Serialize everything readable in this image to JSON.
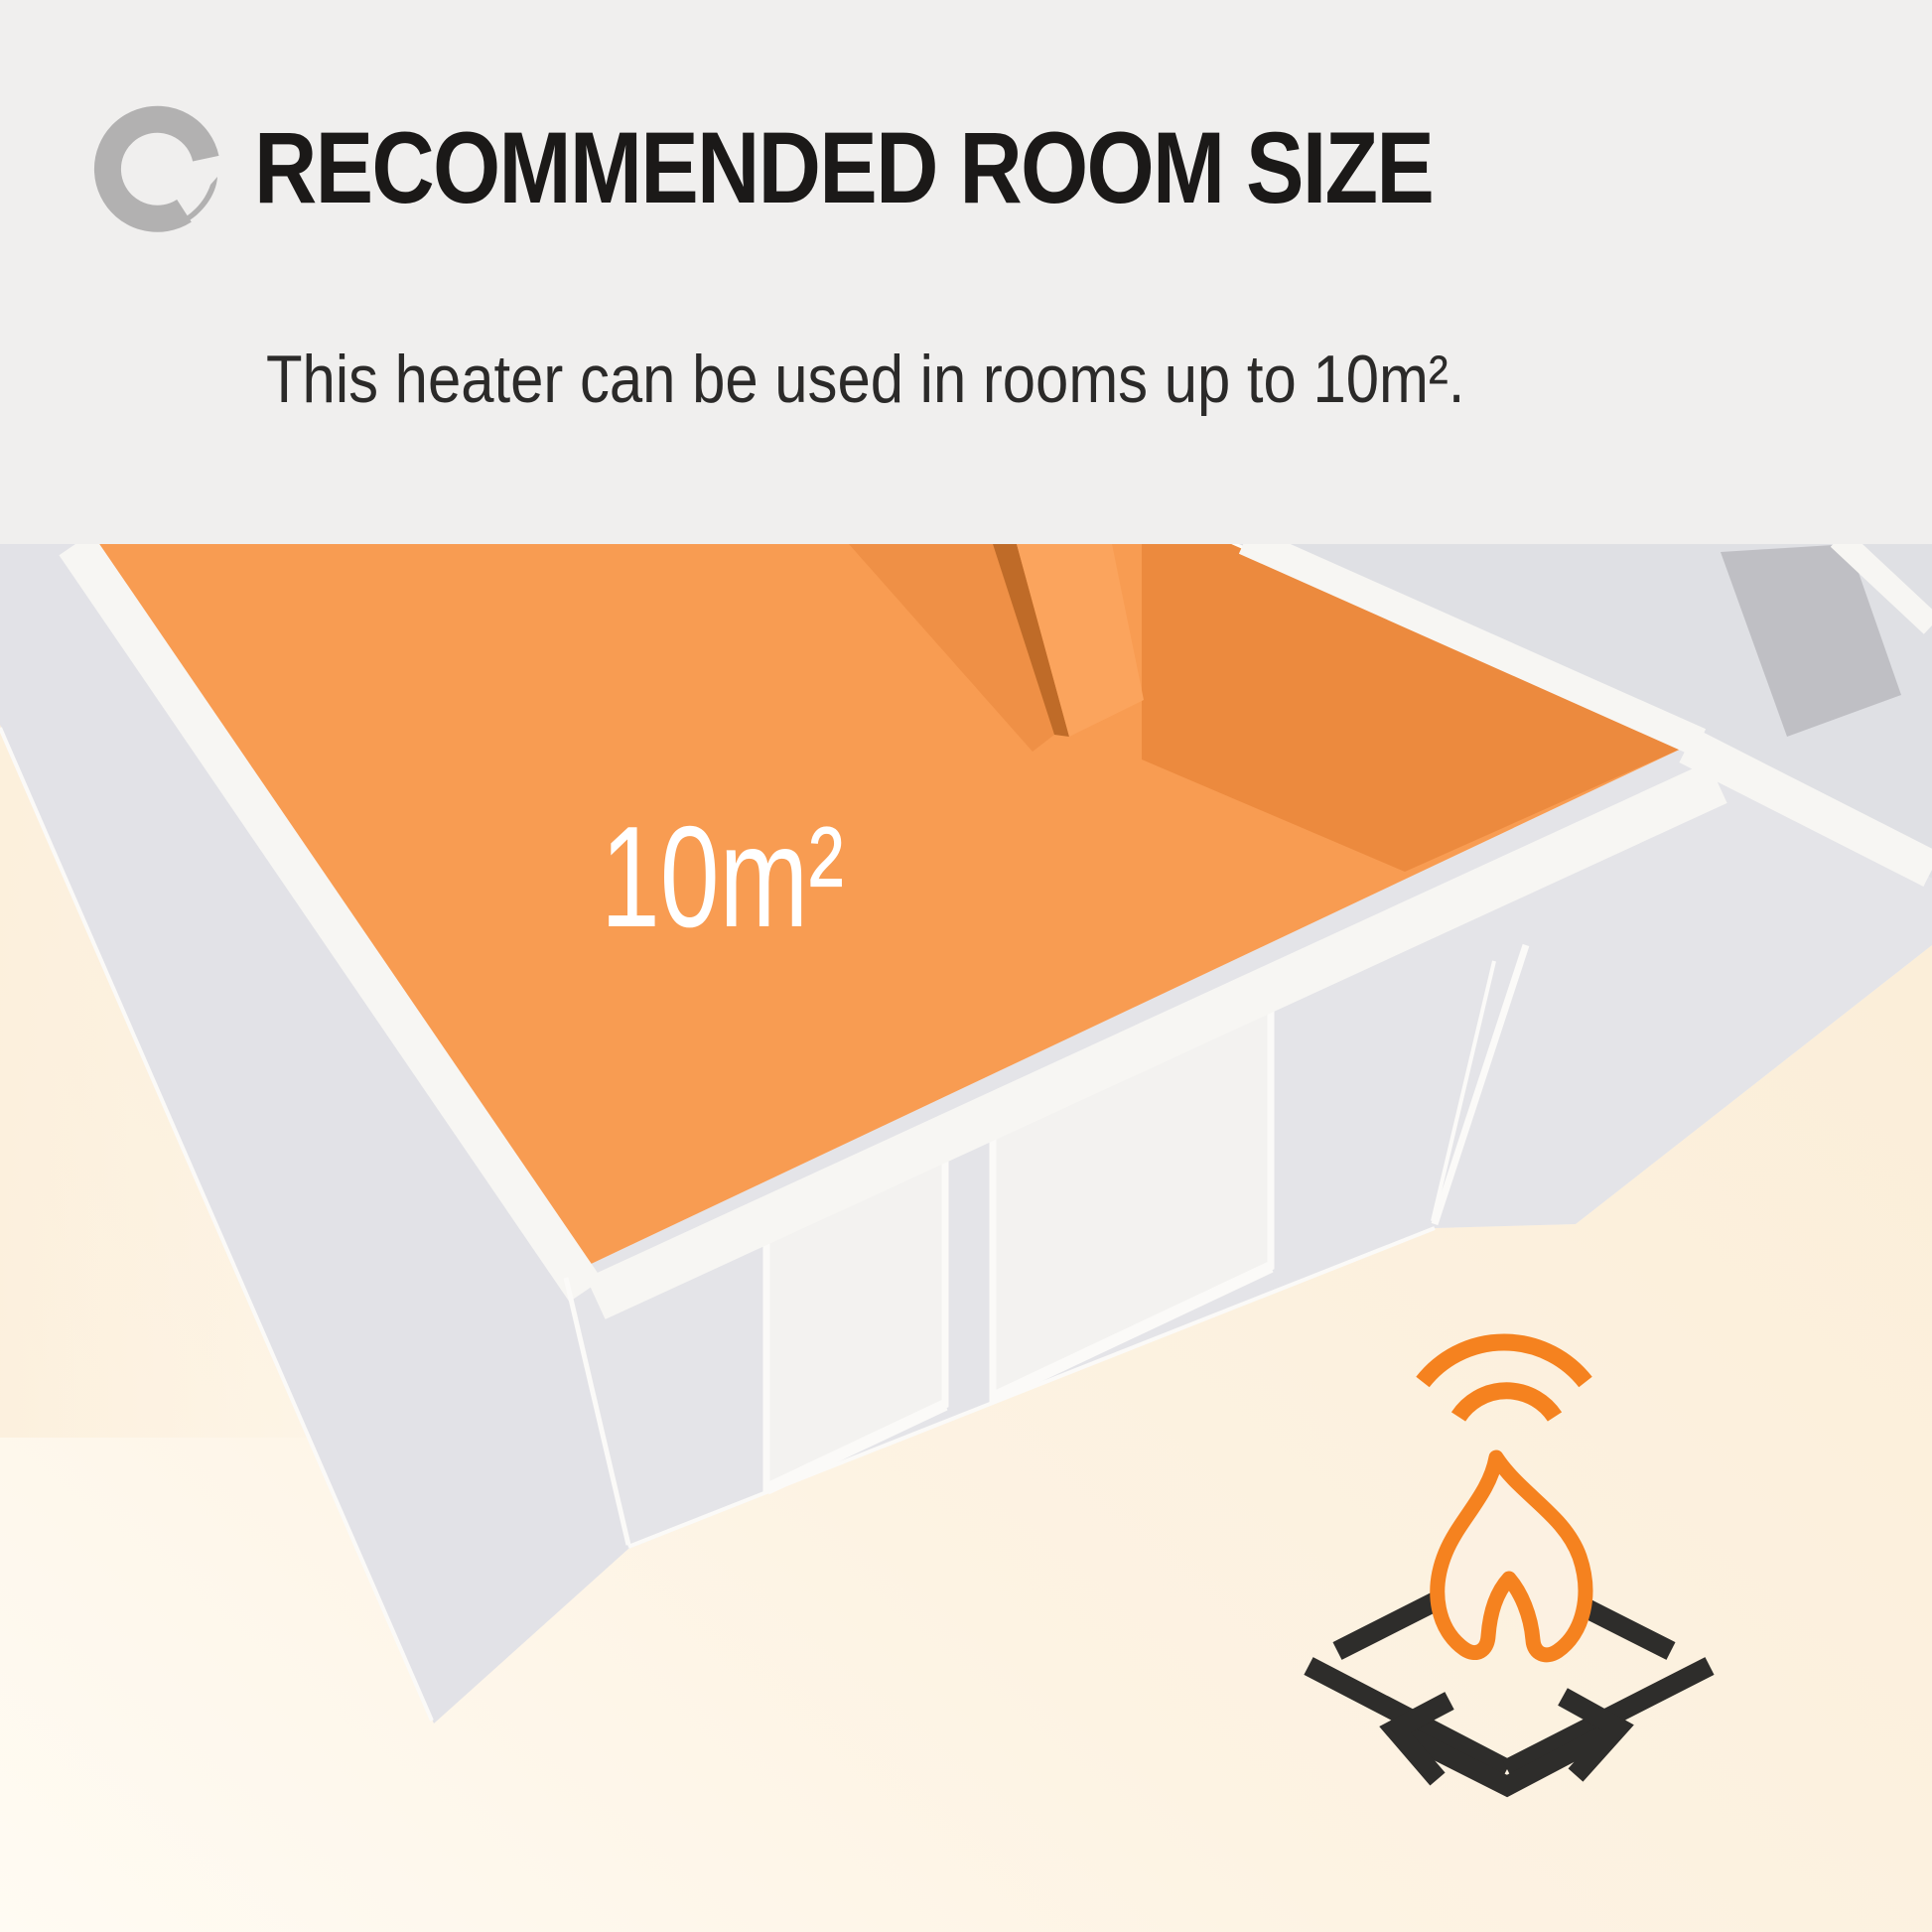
{
  "header": {
    "title": "RECOMMENDED ROOM SIZE",
    "subtitle": "This heater can be used in rooms up to 10m².",
    "background_color": "#f0efee",
    "title_color": "#1b1918",
    "logo_color": "#b2b1b1"
  },
  "room": {
    "floor_label": "10m²",
    "floor_color": "#f89c52",
    "floor_shadow_color": "#ec8a3e",
    "door_leaf_color": "#ef9046",
    "door_edge_color": "#bf6b28",
    "door_light_stripe_color": "#fba45d",
    "wall_face_color": "#e4e4e8",
    "left_wall_color": "#e2e2e7",
    "wall_top_color": "#f7f6f3",
    "window_color": "#f3f2f0",
    "adjacent_room_floor_color": "#dfe0e4",
    "adjacent_room_wall_color": "#bfbfc4",
    "background_glow_color": "#fcf1e0"
  },
  "area_icon": {
    "flame_color": "#f5821f",
    "arrows_color": "#2e2d2b"
  }
}
